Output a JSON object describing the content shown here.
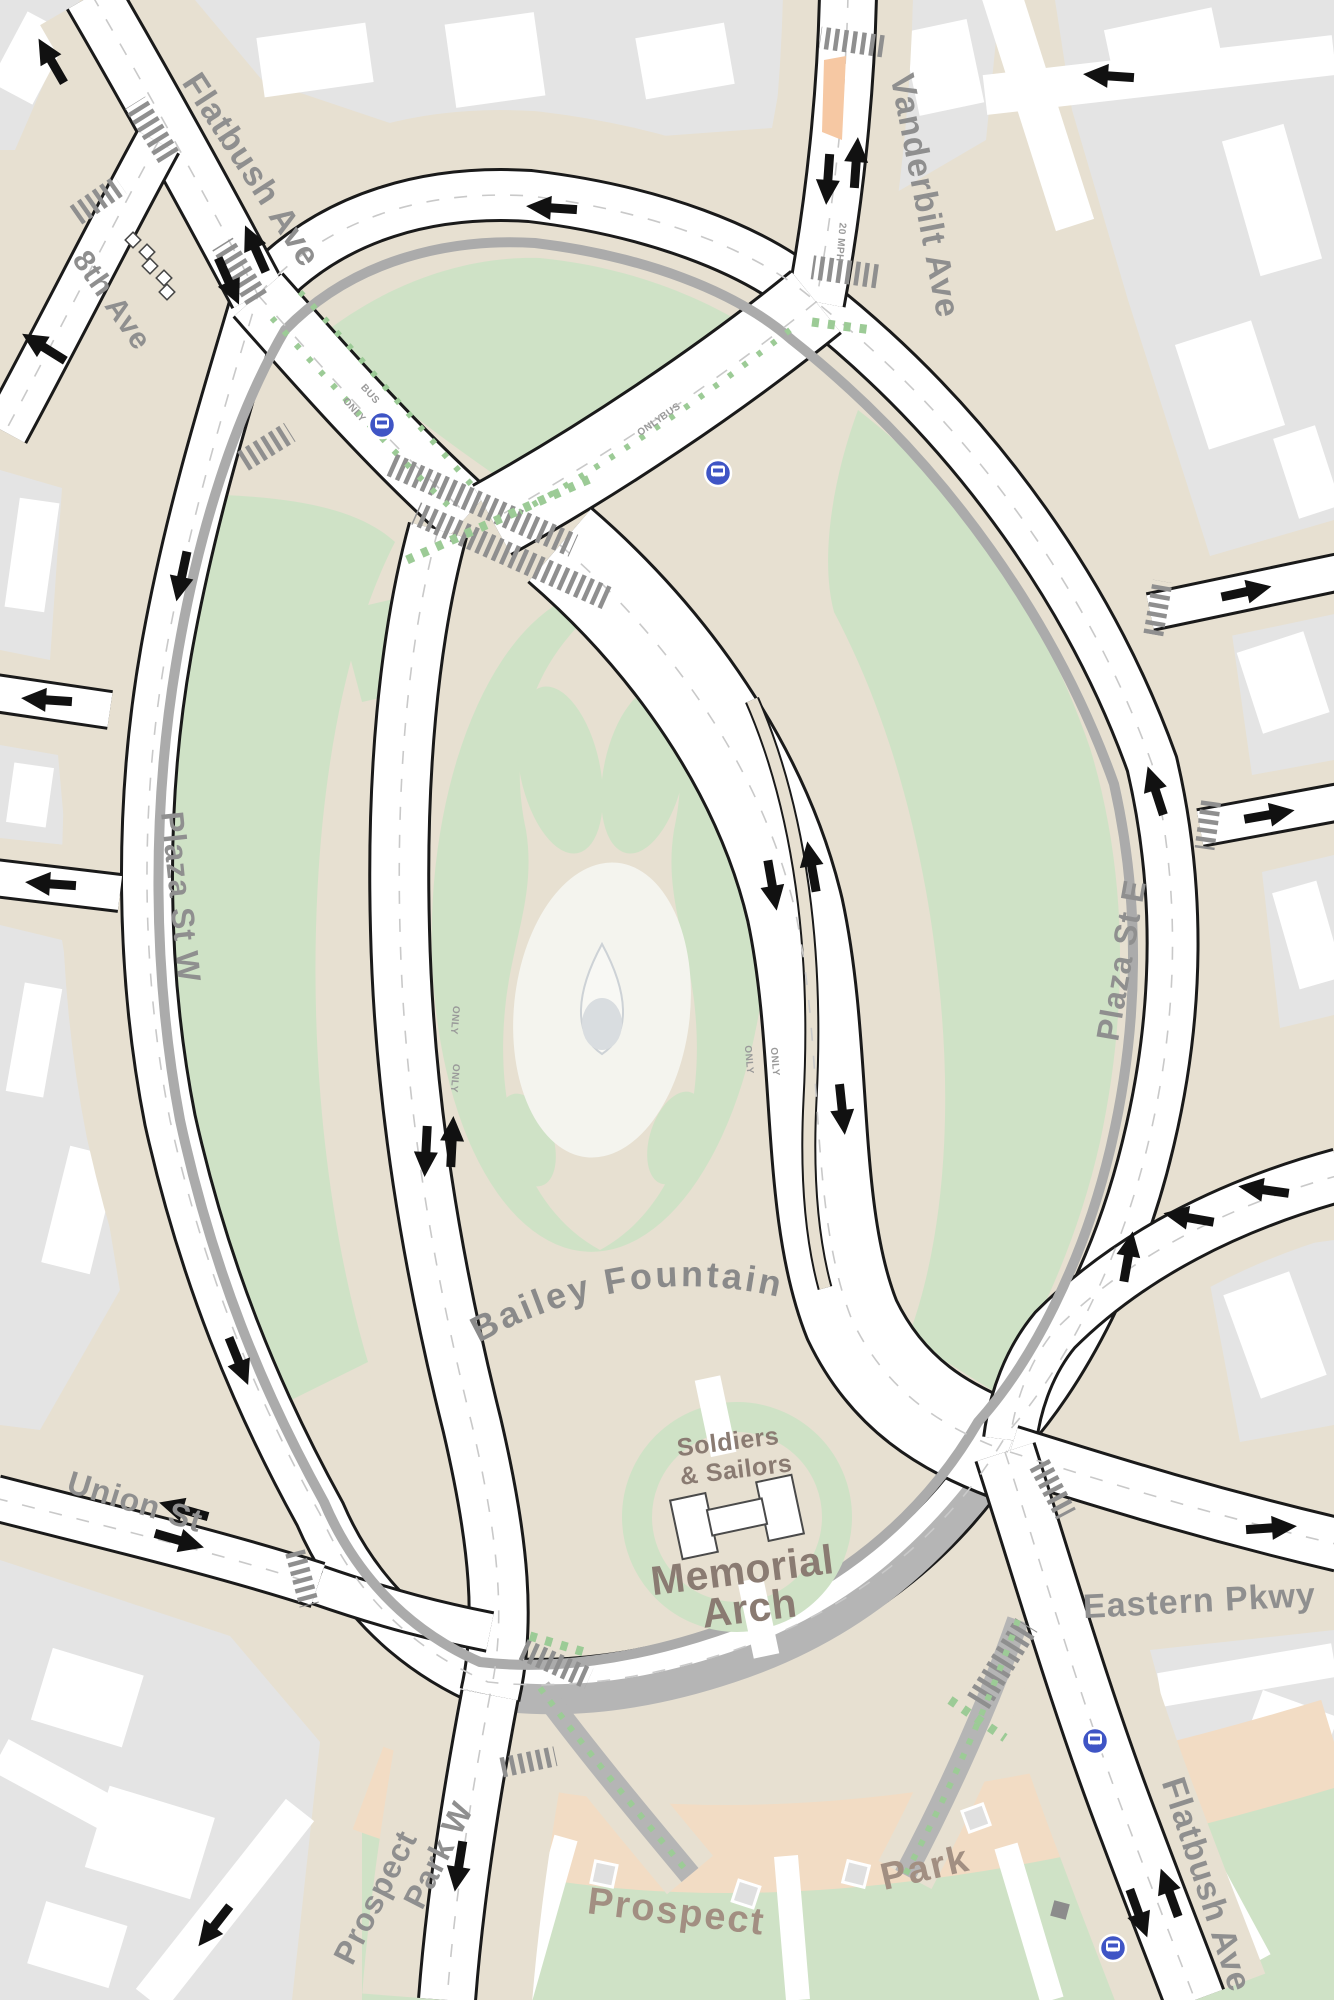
{
  "map": {
    "title": "Grand Army Plaza street plan",
    "streets": {
      "flatbush_top": "Flatbush Ave",
      "flatbush_bottom": "Flatbush Ave",
      "eighth_ave": "8th Ave",
      "vanderbilt": "Vanderbilt Ave",
      "plaza_st_w": "Plaza St W",
      "plaza_st_e": "Plaza St E",
      "union_st": "Union St",
      "eastern_pkwy": "Eastern Pkwy",
      "prospect_park_w_line1": "Prospect",
      "prospect_park_w_line2": "Park W"
    },
    "places": {
      "bailey_fountain": "Bailey Fountain",
      "soldiers": "Soldiers",
      "sailors": "& Sailors",
      "memorial": "Memorial",
      "arch": "Arch",
      "prospect": "Prospect",
      "park": "Park"
    },
    "road_markings": {
      "only": "ONLY",
      "bus": "BUS",
      "vanderbilt_speed": "20 MPH"
    },
    "icons": {
      "bus_stop": "bus-icon",
      "median_marker": "diamond-icon",
      "traffic_arrow": "arrow-icon"
    },
    "colors": {
      "sidewalk_beige": "#e7e0d1",
      "block_gray": "#e4e4e4",
      "building_white": "#ffffff",
      "park_green": "#cfe2c6",
      "road_white": "#ffffff",
      "road_casing": "#1a1a1a",
      "median_gray": "#a9a9a9",
      "shared_street_gray": "#b5b5b5",
      "crosswalk_gray": "#8f8f8f",
      "bike_green": "#9ccb96",
      "refuge_peach": "#f6c8a3",
      "bus_blue": "#3f55c5",
      "street_label_gray": "#8f8f8f",
      "monument_brown": "#8a7b72",
      "park_label_brown": "#a28f82",
      "park_band_pink": "#f2dcc4"
    }
  }
}
